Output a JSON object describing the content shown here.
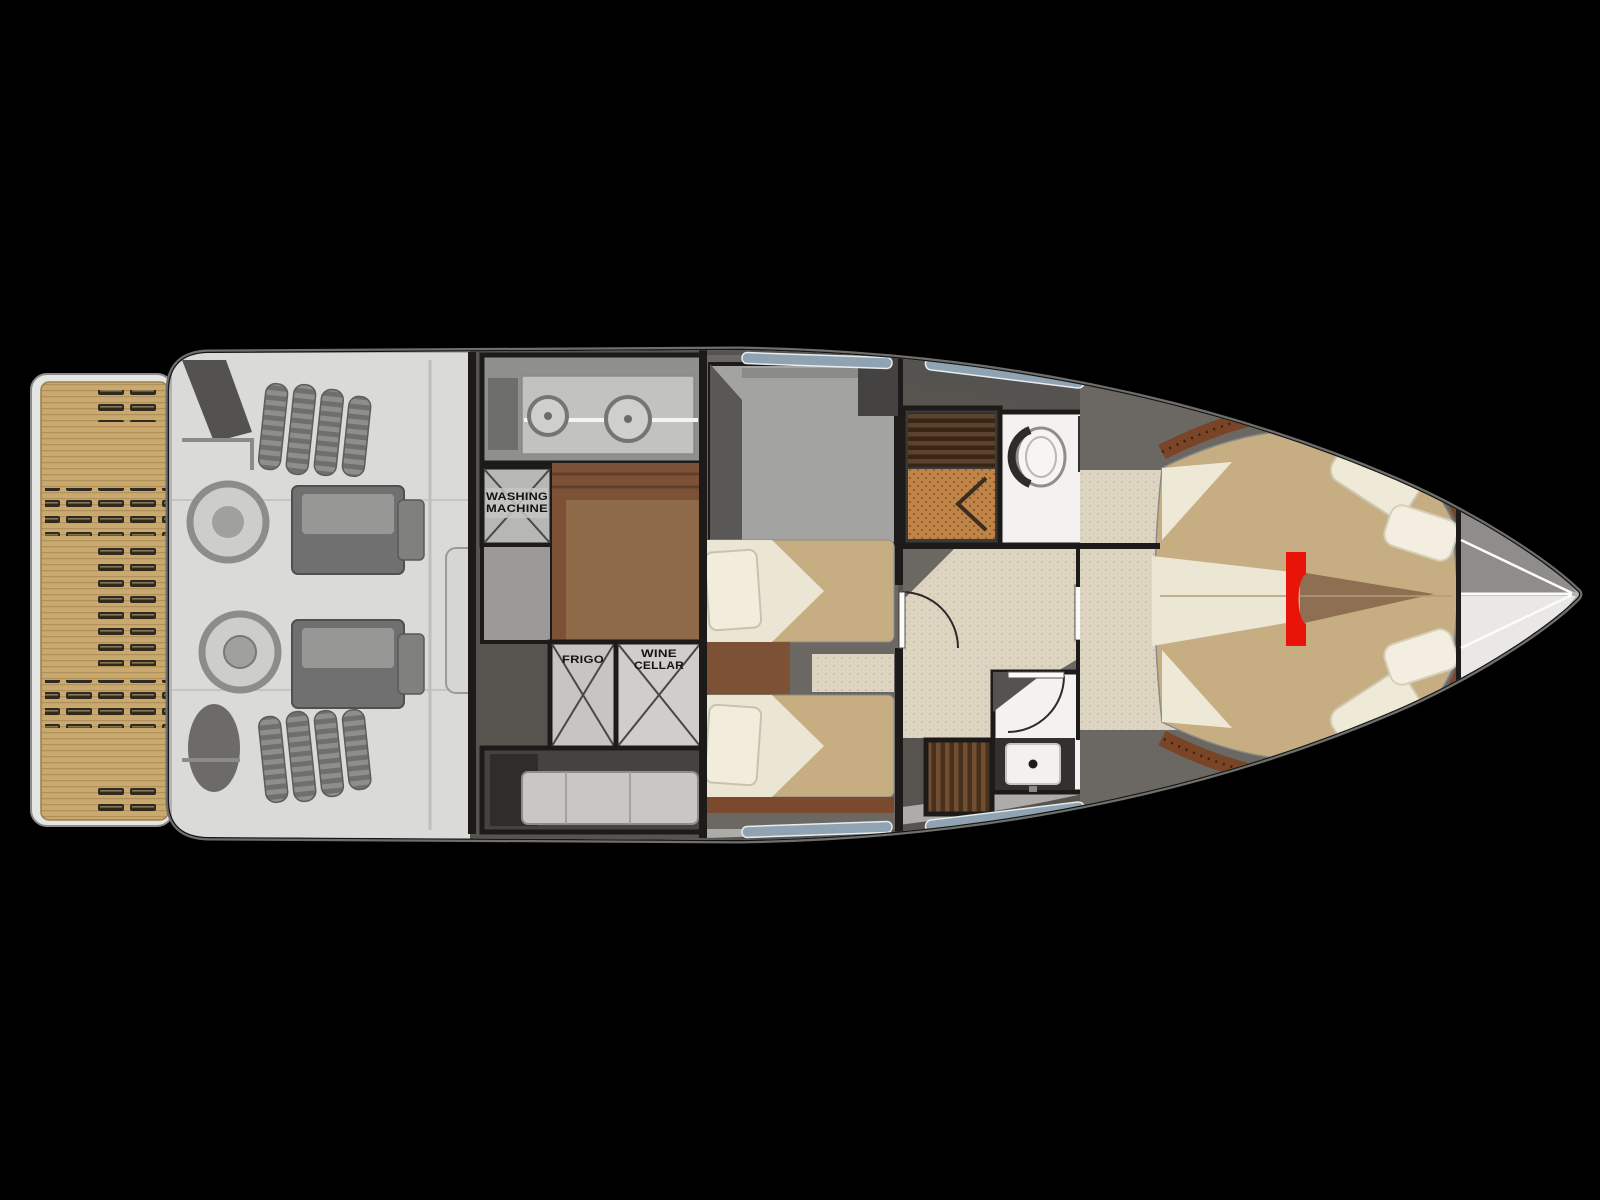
{
  "scene": {
    "description": "yacht lower-deck floor plan on black background",
    "background": "#000000"
  },
  "labels": {
    "washing_machine_line1": "WASHING",
    "washing_machine_line2": "MACHINE",
    "frigo": "FRIGO",
    "wine_cellar_line1": "WINE",
    "wine_cellar_line2": "CELLAR"
  },
  "marker": {
    "name": "red-highlight-bracket",
    "color": "#e81309"
  },
  "palette": {
    "background": "#000000",
    "hull": "#ececea",
    "hull_outline": "#141414",
    "teak_platform": "#c9a96d",
    "walls": "#1d1b19",
    "engine_room_floor": "#dcdcda",
    "engine_block": "#6e6e6e",
    "corridor_wood": "#7c5136",
    "cabin_floor": "#6b6763",
    "bed_tan": "#c7ae82",
    "linen_white": "#ece6d4",
    "bed_frame_wood": "#7b4a2e",
    "bathroom_floor": "#f3f2f0",
    "counter_dark": "#33312f",
    "shower_teak_grate": "#c08448",
    "carpet_beige": "#ddd5c2",
    "wardrobe_wood": "#6f4c2f",
    "window_glass": "#8fa3b2",
    "side_deck_dark": "#55534f",
    "marker_red": "#e81309"
  }
}
